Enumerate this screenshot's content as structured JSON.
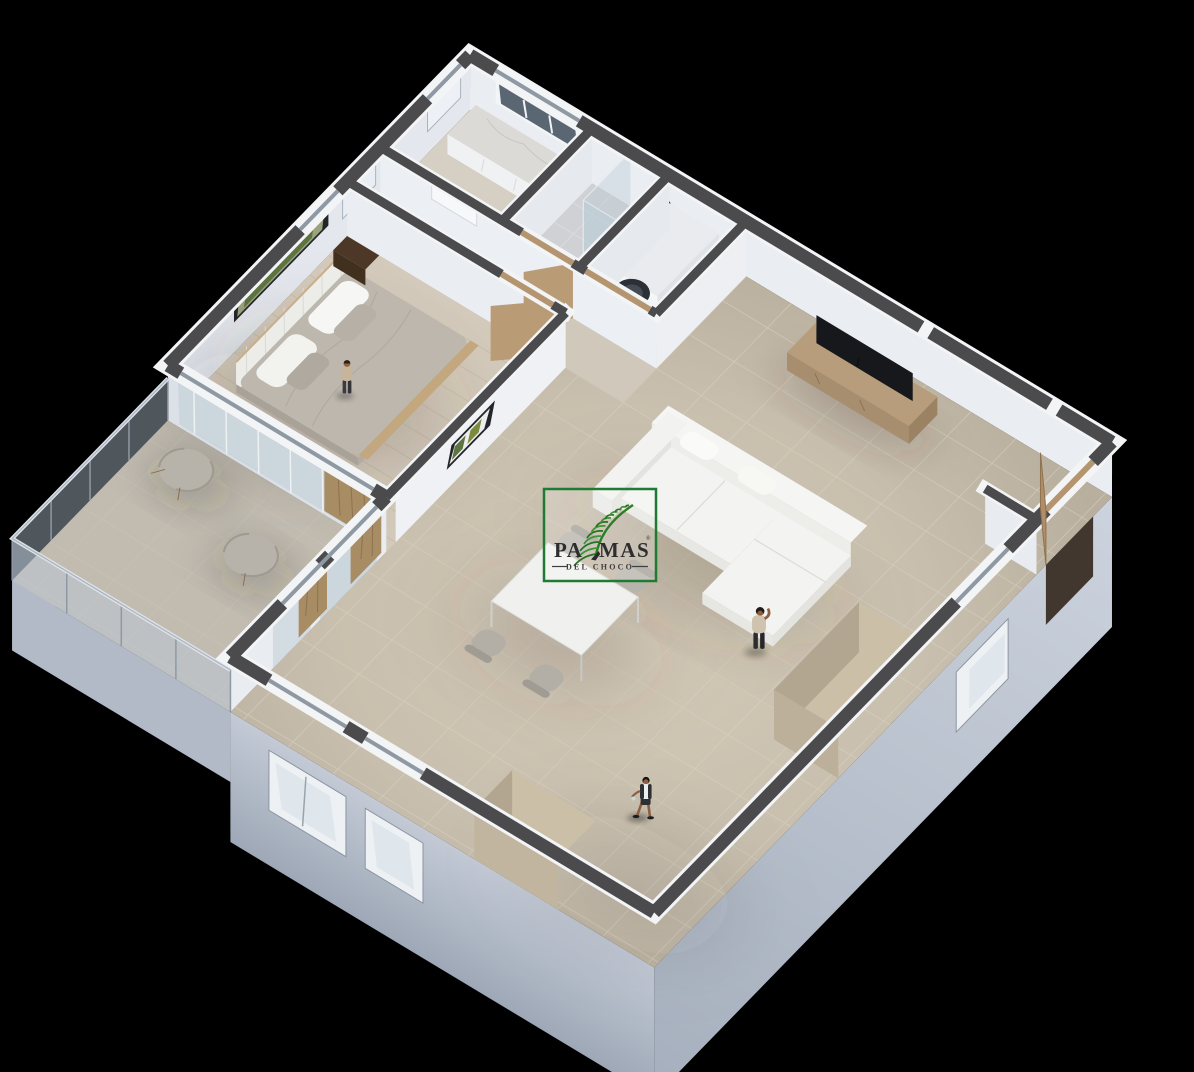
{
  "meta": {
    "width": 1194,
    "height": 1072,
    "background": "#000000",
    "content_type": "3d-isometric-floor-plan-render"
  },
  "logo": {
    "brand": "PALMAS",
    "brand_part1": "PA",
    "brand_part2": "MAS",
    "registered": "®",
    "subtitle": "DEL CHOCO",
    "border_color": "#1f7a33",
    "leaf_green_light": "#3f9434",
    "leaf_green_dark": "#27741f",
    "text_color": "#2e2e30",
    "box_background": "rgba(255,255,255,0.2)"
  },
  "palette": {
    "background": "#000000",
    "wall_top": "#4b4b4e",
    "wall_edge": "#f3f4f6",
    "wall_face": "#eaedf1",
    "facade": "#c2c9d5",
    "floor_living": "#c9bfae",
    "floor_bedroom": "#d4cabb",
    "floor_bath": "#d0d1d4",
    "floor_balcony": "#c1bbb0",
    "wood": "#b99b76",
    "walnut": "#4d3827",
    "sofa": "#f3f3f1",
    "tv": "#16181c",
    "curtain": "#a78c64",
    "glass": "#c9d3da"
  },
  "scene": {
    "rooms": [
      {
        "name": "bedroom",
        "items": [
          "double-bed",
          "headboard",
          "pillows",
          "duvet",
          "nightstand",
          "panorama-artwork",
          "window",
          "curtains",
          "sliding-glass-wall"
        ]
      },
      {
        "name": "bathroom",
        "items": [
          "glass-shower",
          "shower-head",
          "tile-floor",
          "door"
        ]
      },
      {
        "name": "kitchenette",
        "items": [
          "counter",
          "marble-countertop",
          "three-pane-window"
        ]
      },
      {
        "name": "laundry-closet",
        "items": [
          "stacked-washer-dryer",
          "wood-door-frame"
        ]
      },
      {
        "name": "living-dining-room",
        "items": [
          "l-shaped-sofa",
          "tv-console",
          "flat-screen-tv",
          "dining-table",
          "dining-chairs",
          "kitchen-cabinet-island",
          "tall-cabinet",
          "framed-art",
          "entry-door",
          "curtains"
        ]
      },
      {
        "name": "balcony",
        "items": [
          "glass-railing",
          "armchair",
          "armchair",
          "tile-floor"
        ]
      }
    ],
    "people": [
      {
        "name": "person-standing-bedroom"
      },
      {
        "name": "person-on-phone-living-room"
      },
      {
        "name": "person-walking-near-entry"
      }
    ]
  }
}
